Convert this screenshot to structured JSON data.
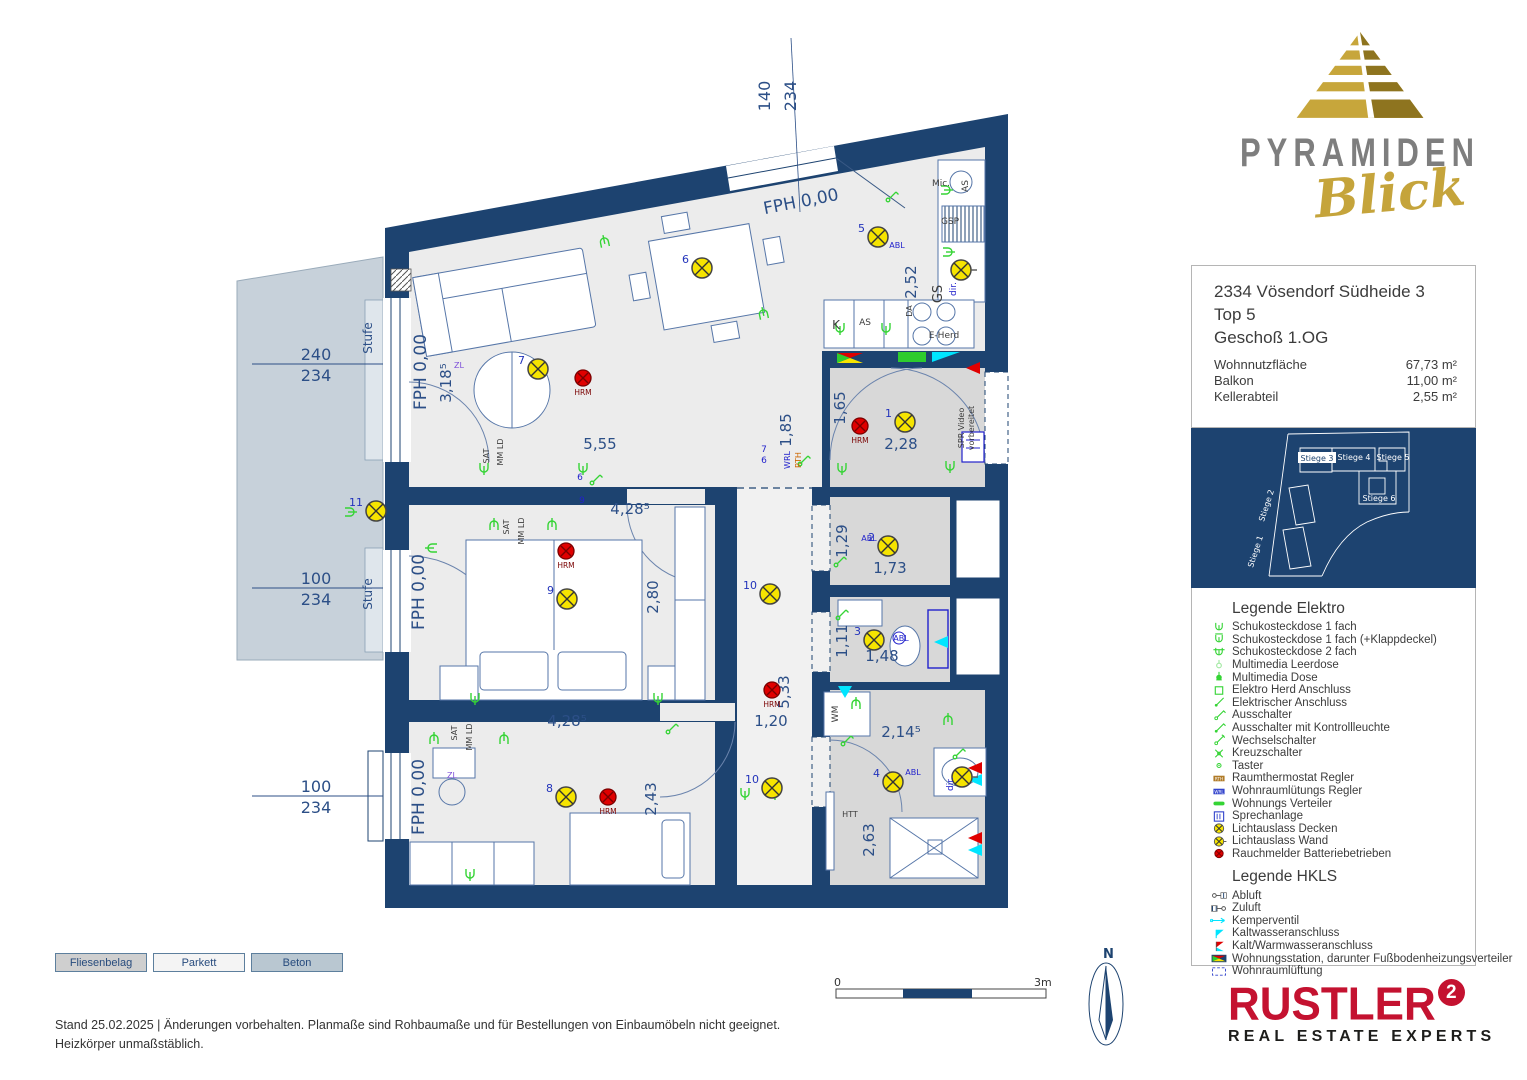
{
  "logo": {
    "brand": "PYRAMIDEN",
    "brand_sub": "Blick"
  },
  "info_box": {
    "address": "2334 Vösendorf Südheide 3",
    "unit": "Top 5",
    "floor": "Geschoß 1.OG",
    "rows": [
      {
        "label": "Wohnnutzfläche",
        "value": "67,73 m²"
      },
      {
        "label": "Balkon",
        "value": "11,00 m²"
      },
      {
        "label": "Kellerabteil",
        "value": "2,55 m²"
      }
    ]
  },
  "site_plan": {
    "units": [
      {
        "label": "Stiege 1",
        "x": 66,
        "y": 124,
        "r": -72,
        "hl": false
      },
      {
        "label": "Stiege 2",
        "x": 77,
        "y": 78,
        "r": -72,
        "hl": false
      },
      {
        "label": "Stiege 3",
        "x": 126,
        "y": 32,
        "r": 0,
        "hl": true
      },
      {
        "label": "Stiege 4",
        "x": 163,
        "y": 31,
        "r": 0,
        "hl": false
      },
      {
        "label": "Stiege 5",
        "x": 202,
        "y": 31,
        "r": 0,
        "hl": false
      },
      {
        "label": "Stiege 6",
        "x": 188,
        "y": 72,
        "r": 0,
        "hl": false
      }
    ]
  },
  "legend_elektro": {
    "title": "Legende Elektro",
    "items": [
      {
        "icon": "sock1",
        "label": "Schukosteckdose 1 fach"
      },
      {
        "icon": "sock1k",
        "label": "Schukosteckdose 1 fach (+Klappdeckel)"
      },
      {
        "icon": "sock2",
        "label": "Schukosteckdose 2 fach"
      },
      {
        "icon": "mmleer",
        "label": "Multimedia Leerdose"
      },
      {
        "icon": "mmdose",
        "label": "Multimedia Dose"
      },
      {
        "icon": "herd",
        "label": "Elektro Herd Anschluss"
      },
      {
        "icon": "elan",
        "label": "Elektrischer Anschluss"
      },
      {
        "icon": "aus",
        "label": "Ausschalter"
      },
      {
        "icon": "ausk",
        "label": "Ausschalter mit Kontrollleuchte"
      },
      {
        "icon": "wechsel",
        "label": "Wechselschalter"
      },
      {
        "icon": "kreuz",
        "label": "Kreuzschalter"
      },
      {
        "icon": "taster",
        "label": "Taster"
      },
      {
        "icon": "rth",
        "label": "Raumthermostat Regler"
      },
      {
        "icon": "wrl",
        "label": "Wohnraumlütungs Regler"
      },
      {
        "icon": "vert",
        "label": "Wohnungs Verteiler"
      },
      {
        "icon": "sprech",
        "label": "Sprechanlage"
      },
      {
        "icon": "lichtd",
        "label": "Lichtauslass Decken"
      },
      {
        "icon": "lichtw",
        "label": "Lichtauslass Wand"
      },
      {
        "icon": "rauch",
        "label": "Rauchmelder Batteriebetrieben"
      }
    ]
  },
  "legend_hkls": {
    "title": "Legende HKLS",
    "items": [
      {
        "icon": "abluft",
        "label": "Abluft"
      },
      {
        "icon": "zuluft",
        "label": "Zuluft"
      },
      {
        "icon": "kemper",
        "label": "Kemperventil"
      },
      {
        "icon": "kw",
        "label": "Kaltwasseranschluss"
      },
      {
        "icon": "kww",
        "label": "Kalt/Warmwasseranschluss"
      },
      {
        "icon": "wst",
        "label": "Wohnungsstation, darunter Fußbodenheizungsverteiler"
      },
      {
        "icon": "wrlu",
        "label": "Wohnraumlüftung"
      }
    ]
  },
  "materials": {
    "items": [
      {
        "label": "Fliesenbelag",
        "fill": "#cfcfcf"
      },
      {
        "label": "Parkett",
        "fill": "#f4f4f4"
      },
      {
        "label": "Beton",
        "fill": "#b9c7d1"
      }
    ]
  },
  "footer": {
    "line1": "Stand 25.02.2025 | Änderungen vorbehalten. Planmaße sind Rohbaumaße und für Bestellungen von Einbaumöbeln nicht geeignet.",
    "line2": "Heizkörper unmaßstäblich."
  },
  "scale_bar": {
    "start": "0",
    "end": "3m"
  },
  "compass": {
    "label": "N"
  },
  "rustler": {
    "name": "RUSTLER",
    "sup": "2",
    "tagline": "REAL ESTATE EXPERTS"
  },
  "floorplan": {
    "fph_labels": [
      {
        "text": "FPH 0,00",
        "x": 426,
        "y": 372,
        "r": -90
      },
      {
        "text": "FPH 0,00",
        "x": 802,
        "y": 207,
        "r": -11
      },
      {
        "text": "FPH 0,00",
        "x": 424,
        "y": 592,
        "r": -90
      },
      {
        "text": "FPH 0,00",
        "x": 424,
        "y": 797,
        "r": -90
      }
    ],
    "window_dims": [
      {
        "top": "240",
        "bottom": "234",
        "x": 316,
        "y": 360,
        "lx1": 252,
        "lx2": 383,
        "stufe": "Stufe",
        "sx": 372,
        "sy": 338
      },
      {
        "top": "100",
        "bottom": "234",
        "x": 316,
        "y": 584,
        "lx1": 252,
        "lx2": 383,
        "stufe": "Stufe",
        "sx": 372,
        "sy": 594
      },
      {
        "top": "100",
        "bottom": "234",
        "x": 316,
        "y": 792,
        "lx1": 252,
        "lx2": 383,
        "stufe": "",
        "sx": 0,
        "sy": 0
      }
    ],
    "top_dim": {
      "top": "140",
      "bottom": "234",
      "x": 770,
      "y": 96
    },
    "dims": [
      {
        "t": "5,55",
        "x": 600,
        "y": 449
      },
      {
        "t": "3,18⁵",
        "x": 451,
        "y": 383,
        "r": -90
      },
      {
        "t": "2,52",
        "x": 916,
        "y": 282,
        "r": -90
      },
      {
        "t": "1,85",
        "x": 791,
        "y": 430,
        "r": -90
      },
      {
        "t": "1,65",
        "x": 845,
        "y": 408,
        "r": -90
      },
      {
        "t": "2,28",
        "x": 901,
        "y": 449
      },
      {
        "t": "1,29",
        "x": 847,
        "y": 541,
        "r": -90
      },
      {
        "t": "1,73",
        "x": 890,
        "y": 573
      },
      {
        "t": "1,11",
        "x": 847,
        "y": 641,
        "r": -90
      },
      {
        "t": "1,48",
        "x": 882,
        "y": 661
      },
      {
        "t": "2,80",
        "x": 658,
        "y": 597,
        "r": -90
      },
      {
        "t": "4,28⁵",
        "x": 630,
        "y": 514
      },
      {
        "t": "4,28⁵",
        "x": 567,
        "y": 726
      },
      {
        "t": "2,43",
        "x": 656,
        "y": 799,
        "r": -90
      },
      {
        "t": "5,33",
        "x": 789,
        "y": 692,
        "r": -90
      },
      {
        "t": "1,20",
        "x": 771,
        "y": 726
      },
      {
        "t": "2,14⁵",
        "x": 901,
        "y": 737
      },
      {
        "t": "2,63",
        "x": 874,
        "y": 840,
        "r": -90
      }
    ],
    "lights": [
      {
        "n": "1",
        "x": 905,
        "y": 422
      },
      {
        "n": "2",
        "x": 888,
        "y": 546
      },
      {
        "n": "3",
        "x": 874,
        "y": 640
      },
      {
        "n": "4",
        "x": 893,
        "y": 782
      },
      {
        "n": "5",
        "x": 878,
        "y": 237
      },
      {
        "n": "6",
        "x": 702,
        "y": 268
      },
      {
        "n": "7",
        "x": 538,
        "y": 369
      },
      {
        "n": "8",
        "x": 566,
        "y": 797
      },
      {
        "n": "9",
        "x": 567,
        "y": 599
      },
      {
        "n": "10",
        "x": 770,
        "y": 594
      },
      {
        "n": "10",
        "x": 772,
        "y": 788
      },
      {
        "n": "11",
        "x": 376,
        "y": 511
      },
      {
        "n": "",
        "x": 961,
        "y": 270,
        "wall": true
      },
      {
        "n": "",
        "x": 962,
        "y": 777,
        "wall": true
      }
    ],
    "smoke_label": "HRM",
    "smoke": [
      {
        "x": 583,
        "y": 378
      },
      {
        "x": 860,
        "y": 426
      },
      {
        "x": 566,
        "y": 551
      },
      {
        "x": 772,
        "y": 690
      },
      {
        "x": 608,
        "y": 797
      }
    ],
    "labels": [
      {
        "t": "SAT",
        "x": 489,
        "y": 456,
        "r": -90,
        "s": 8
      },
      {
        "t": "MM LD",
        "x": 503,
        "y": 452,
        "r": -90,
        "s": 8
      },
      {
        "t": "SAT",
        "x": 509,
        "y": 527,
        "r": -90,
        "s": 8
      },
      {
        "t": "MM LD",
        "x": 524,
        "y": 531,
        "r": -90,
        "s": 8
      },
      {
        "t": "SAT",
        "x": 457,
        "y": 733,
        "r": -90,
        "s": 8
      },
      {
        "t": "MM LD",
        "x": 472,
        "y": 737,
        "r": -90,
        "s": 8
      },
      {
        "t": "ZL",
        "x": 459,
        "y": 368,
        "s": 8,
        "c": "#7d4fd8"
      },
      {
        "t": "ZL",
        "x": 452,
        "y": 778,
        "s": 8,
        "c": "#7d4fd8"
      },
      {
        "t": "WRL",
        "x": 790,
        "y": 460,
        "r": -90,
        "s": 8,
        "c": "#2222cc"
      },
      {
        "t": "RTH",
        "x": 801,
        "y": 460,
        "r": -90,
        "s": 8,
        "c": "#cc6600"
      },
      {
        "t": "Mic.",
        "x": 941,
        "y": 186,
        "s": 9
      },
      {
        "t": "GSP",
        "x": 950,
        "y": 224,
        "s": 9
      },
      {
        "t": "GS",
        "x": 942,
        "y": 294,
        "r": -90,
        "s": 13
      },
      {
        "t": "dir.",
        "x": 956,
        "y": 289,
        "r": -90,
        "s": 9,
        "c": "#2222cc"
      },
      {
        "t": "dir.",
        "x": 953,
        "y": 784,
        "r": -90,
        "s": 9,
        "c": "#2222cc"
      },
      {
        "t": "AS",
        "x": 865,
        "y": 325,
        "s": 9
      },
      {
        "t": "K",
        "x": 836,
        "y": 329,
        "s": 12
      },
      {
        "t": "AS",
        "x": 968,
        "y": 186,
        "r": -90,
        "s": 9
      },
      {
        "t": "DA",
        "x": 912,
        "y": 311,
        "r": -90,
        "s": 8
      },
      {
        "t": "E-Herd",
        "x": 944,
        "y": 338,
        "s": 9
      },
      {
        "t": "WM",
        "x": 838,
        "y": 714,
        "r": -90,
        "s": 9
      },
      {
        "t": "HTT",
        "x": 850,
        "y": 817,
        "s": 8
      },
      {
        "t": "SPR Video",
        "x": 964,
        "y": 428,
        "r": -90,
        "s": 8
      },
      {
        "t": "vorbereitet",
        "x": 974,
        "y": 428,
        "r": -90,
        "s": 8
      },
      {
        "t": "ABL",
        "x": 897,
        "y": 248,
        "s": 8,
        "c": "#2222cc"
      },
      {
        "t": "ABL",
        "x": 869,
        "y": 541,
        "s": 8,
        "c": "#2222cc"
      },
      {
        "t": "ABL",
        "x": 901,
        "y": 641,
        "s": 8,
        "c": "#2222cc"
      },
      {
        "t": "ABL",
        "x": 913,
        "y": 775,
        "s": 8,
        "c": "#2222cc"
      },
      {
        "t": "6",
        "x": 580,
        "y": 480,
        "s": 9,
        "c": "#2222cc"
      },
      {
        "t": "9",
        "x": 582,
        "y": 503,
        "s": 9,
        "c": "#2222cc"
      },
      {
        "t": "7",
        "x": 764,
        "y": 452,
        "s": 9,
        "c": "#2222cc"
      },
      {
        "t": "6",
        "x": 764,
        "y": 463,
        "s": 9,
        "c": "#2222cc"
      }
    ],
    "green_symbols": [
      {
        "x": 604,
        "y": 240,
        "t": "s",
        "r": 168
      },
      {
        "x": 763,
        "y": 312,
        "t": "s",
        "r": 168
      },
      {
        "x": 352,
        "y": 512,
        "t": "s",
        "r": -90
      },
      {
        "x": 484,
        "y": 470,
        "t": "s",
        "r": 0
      },
      {
        "x": 583,
        "y": 470,
        "t": "s",
        "r": 0
      },
      {
        "x": 840,
        "y": 330,
        "t": "s",
        "r": 0
      },
      {
        "x": 886,
        "y": 330,
        "t": "s",
        "r": 0
      },
      {
        "x": 948,
        "y": 190,
        "t": "s",
        "r": -90
      },
      {
        "x": 950,
        "y": 252,
        "t": "s",
        "r": -90
      },
      {
        "x": 494,
        "y": 523,
        "t": "s",
        "r": 180
      },
      {
        "x": 552,
        "y": 523,
        "t": "s",
        "r": 180
      },
      {
        "x": 430,
        "y": 548,
        "t": "s",
        "r": 90
      },
      {
        "x": 475,
        "y": 700,
        "t": "s",
        "r": 0
      },
      {
        "x": 658,
        "y": 700,
        "t": "s",
        "r": 0
      },
      {
        "x": 434,
        "y": 737,
        "t": "s",
        "r": 180
      },
      {
        "x": 504,
        "y": 737,
        "t": "s",
        "r": 180
      },
      {
        "x": 470,
        "y": 876,
        "t": "s",
        "r": 0
      },
      {
        "x": 745,
        "y": 795,
        "t": "s",
        "r": 0
      },
      {
        "x": 775,
        "y": 795,
        "t": "s",
        "r": 0
      },
      {
        "x": 842,
        "y": 470,
        "t": "s",
        "r": 0
      },
      {
        "x": 950,
        "y": 468,
        "t": "s",
        "r": 0
      },
      {
        "x": 856,
        "y": 702,
        "t": "s",
        "r": 180
      },
      {
        "x": 948,
        "y": 718,
        "t": "s",
        "r": 180
      },
      {
        "x": 592,
        "y": 483,
        "t": "w",
        "r": 0
      },
      {
        "x": 800,
        "y": 464,
        "t": "w",
        "r": 0
      },
      {
        "x": 836,
        "y": 565,
        "t": "w",
        "r": 0
      },
      {
        "x": 838,
        "y": 618,
        "t": "w",
        "r": 0
      },
      {
        "x": 843,
        "y": 744,
        "t": "w",
        "r": 0
      },
      {
        "x": 668,
        "y": 732,
        "t": "w",
        "r": 0
      },
      {
        "x": 955,
        "y": 757,
        "t": "w",
        "r": 0
      },
      {
        "x": 888,
        "y": 200,
        "t": "w",
        "r": 0
      }
    ]
  }
}
